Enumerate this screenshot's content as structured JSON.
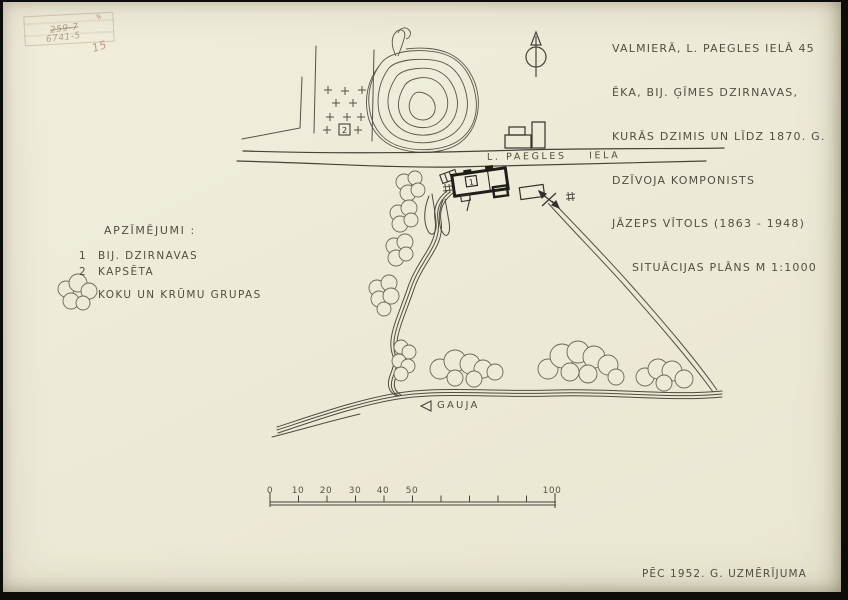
{
  "document": {
    "title_block": {
      "lines": [
        "VALMIERĀ, L. PAEGLES IELĀ 45",
        "ĒKA, BIJ. ĢĪMES DZIRNAVAS,",
        "KURĀS DZIMIS UN LĪDZ 1870. G.",
        "DZĪVOJA KOMPONISTS",
        "JĀZEPS VĪTOLS (1863 - 1948)",
        "SITUĀCIJAS PLĀNS M 1:1000"
      ]
    },
    "legend": {
      "heading": "APZĪMĒJUMI :",
      "items": [
        {
          "key": "1",
          "label": "BIJ. DZIRNAVAS"
        },
        {
          "key": "2",
          "label": "KAPSĒTA"
        }
      ],
      "cloud_item_label": "KOKU UN KRŪMU GRUPAS",
      "cloud_icon": "tree-and-shrub-group-icon"
    },
    "map": {
      "street_label": "L. PAEGLES    IELA",
      "river_label": "GAUJA",
      "building_number": "1",
      "cemetery_number": "2",
      "north_icon": "north-arrow-icon"
    },
    "scale_bar": {
      "labels": [
        "0",
        "10",
        "20",
        "30",
        "40",
        "50",
        "100"
      ],
      "unlabeled_tick_values": [
        60,
        70,
        80,
        90
      ]
    },
    "footer_note": "PĒC 1952. G. UZMĒRĪJUMA",
    "stamp": {
      "scribble_top": "259-7",
      "scribble_mid": "6741-5",
      "scribble_side": "15",
      "scribble_mark": "≠"
    },
    "colors": {
      "paper": "#edead8",
      "ink": "#403e33",
      "line": "#55524a",
      "building": "#201f1a",
      "frame": "#0c0c0a",
      "stamp": "#a9805c"
    }
  }
}
